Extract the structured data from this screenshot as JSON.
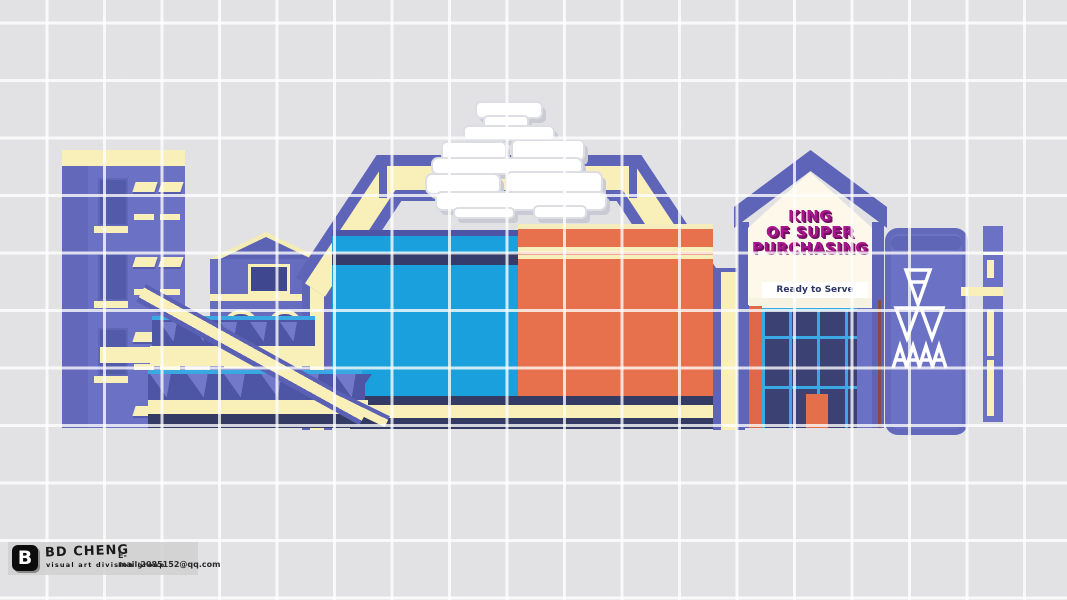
{
  "artwork": {
    "type": "3d-building-facade-concept-render",
    "sign_building": {
      "line1": "KING",
      "line2": "OF SUPER",
      "line3": "PURCHASING",
      "banner": "Ready to Serve"
    },
    "watermark": {
      "logo_letter": "B",
      "brand": "BD CHENG",
      "subtitle": "visual art division group",
      "email": "E-mail:2085152@qq.com"
    },
    "icons": {
      "center_logo": "chinese-calligraphy-3d-logo",
      "right_slab_glyphs": [
        "down-triangle-icon",
        "double-down-triangle-icon",
        "quad-a-triangle-icon"
      ]
    },
    "palette": {
      "background": "#e2e2e4",
      "grid_line": "#ffffff",
      "facade_purple": "#6b71c4",
      "frame_purple": "#5e65b8",
      "trim_cream": "#f8efb9",
      "billboard_blue": "#1aa0dc",
      "billboard_orange": "#e8714d",
      "stripe_navy": "#333b64",
      "mullion_cyan": "#3aa8e3",
      "sign_magenta": "#a7168d",
      "glass_navy": "#3b4273",
      "house_white": "#fdf8ea"
    }
  }
}
